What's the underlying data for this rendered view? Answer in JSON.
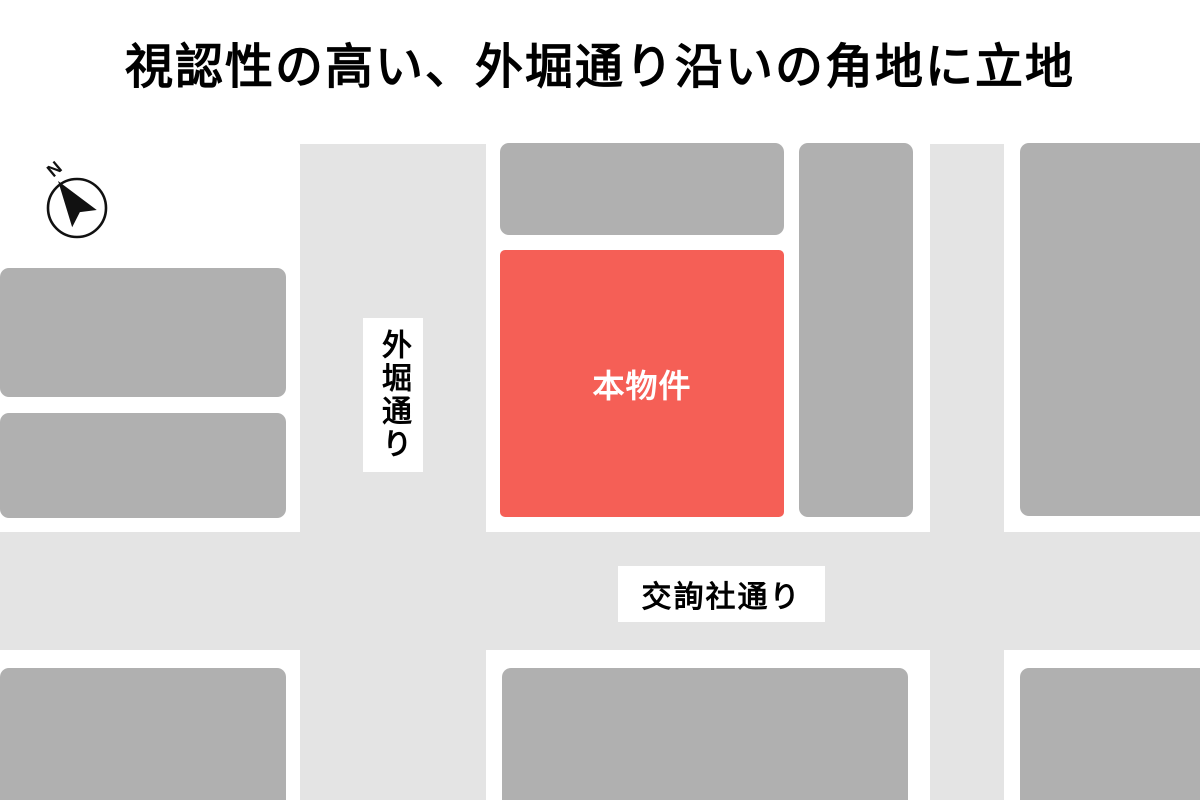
{
  "title": "視認性の高い、外堀通り沿いの角地に立地",
  "compass": {
    "label": "N"
  },
  "map": {
    "property": {
      "label": "本物件"
    },
    "streets": {
      "vertical": {
        "label": "外堀通り"
      },
      "horizontal": {
        "label": "交詢社通り"
      }
    }
  },
  "colors": {
    "road": "#e4e4e4",
    "building": "#b0b0b0",
    "property": "#f55f56",
    "property-text": "#ffffff",
    "label-bg": "#ffffff",
    "ink": "#000000"
  }
}
